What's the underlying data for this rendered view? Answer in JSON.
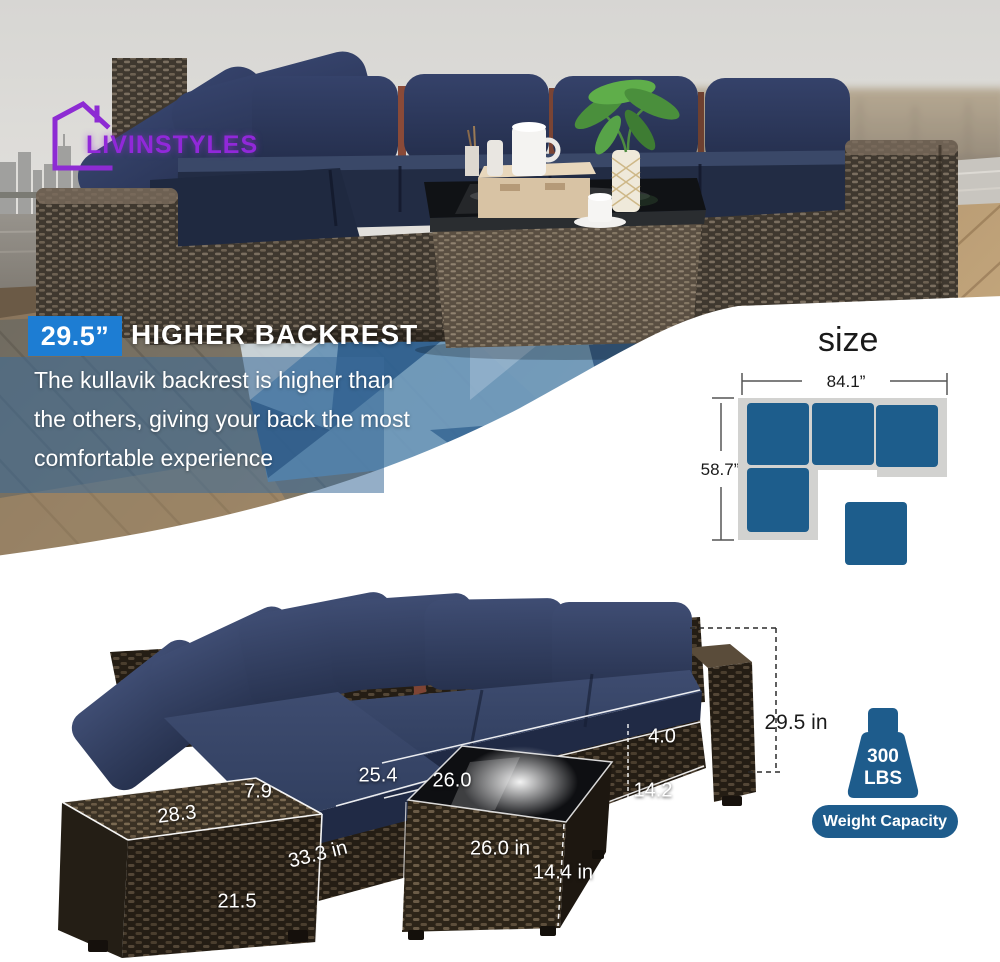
{
  "logo": {
    "text": "LIVINSTYLES"
  },
  "banner": {
    "highlight": "29.5”",
    "title": "HIGHER BACKREST",
    "line1": "The kullavik backrest is higher than",
    "line2": "the others, giving your back the most",
    "line3": "comfortable experience"
  },
  "size_diagram": {
    "title": "size",
    "width_label": "84.1”",
    "height_label": "58.7”"
  },
  "dimensions": {
    "backrest_height": "29.5 in",
    "cushion_thickness": "4.0",
    "seat_depth": "25.4",
    "table_top_depth": "26.0",
    "base_height": "14.2",
    "arm_top_width": "7.9",
    "arm_depth": "28.3",
    "seat_width": "33.3 in",
    "arm_front_height": "21.5",
    "table_width": "26.0 in",
    "table_height": "14.4 in"
  },
  "weight": {
    "value": "300",
    "unit": "LBS",
    "label": "Weight Capacity"
  },
  "colors": {
    "accent_blue": "#1d7dd3",
    "diagram_blue": "#1d5d8c",
    "badge_blue": "#1e5c8c",
    "cushion_navy": "#2c3856",
    "logo_purple": "#9128d9",
    "wicker_brown": "#3a3128",
    "band_overlay": "rgba(60,107,153,0.55)"
  }
}
